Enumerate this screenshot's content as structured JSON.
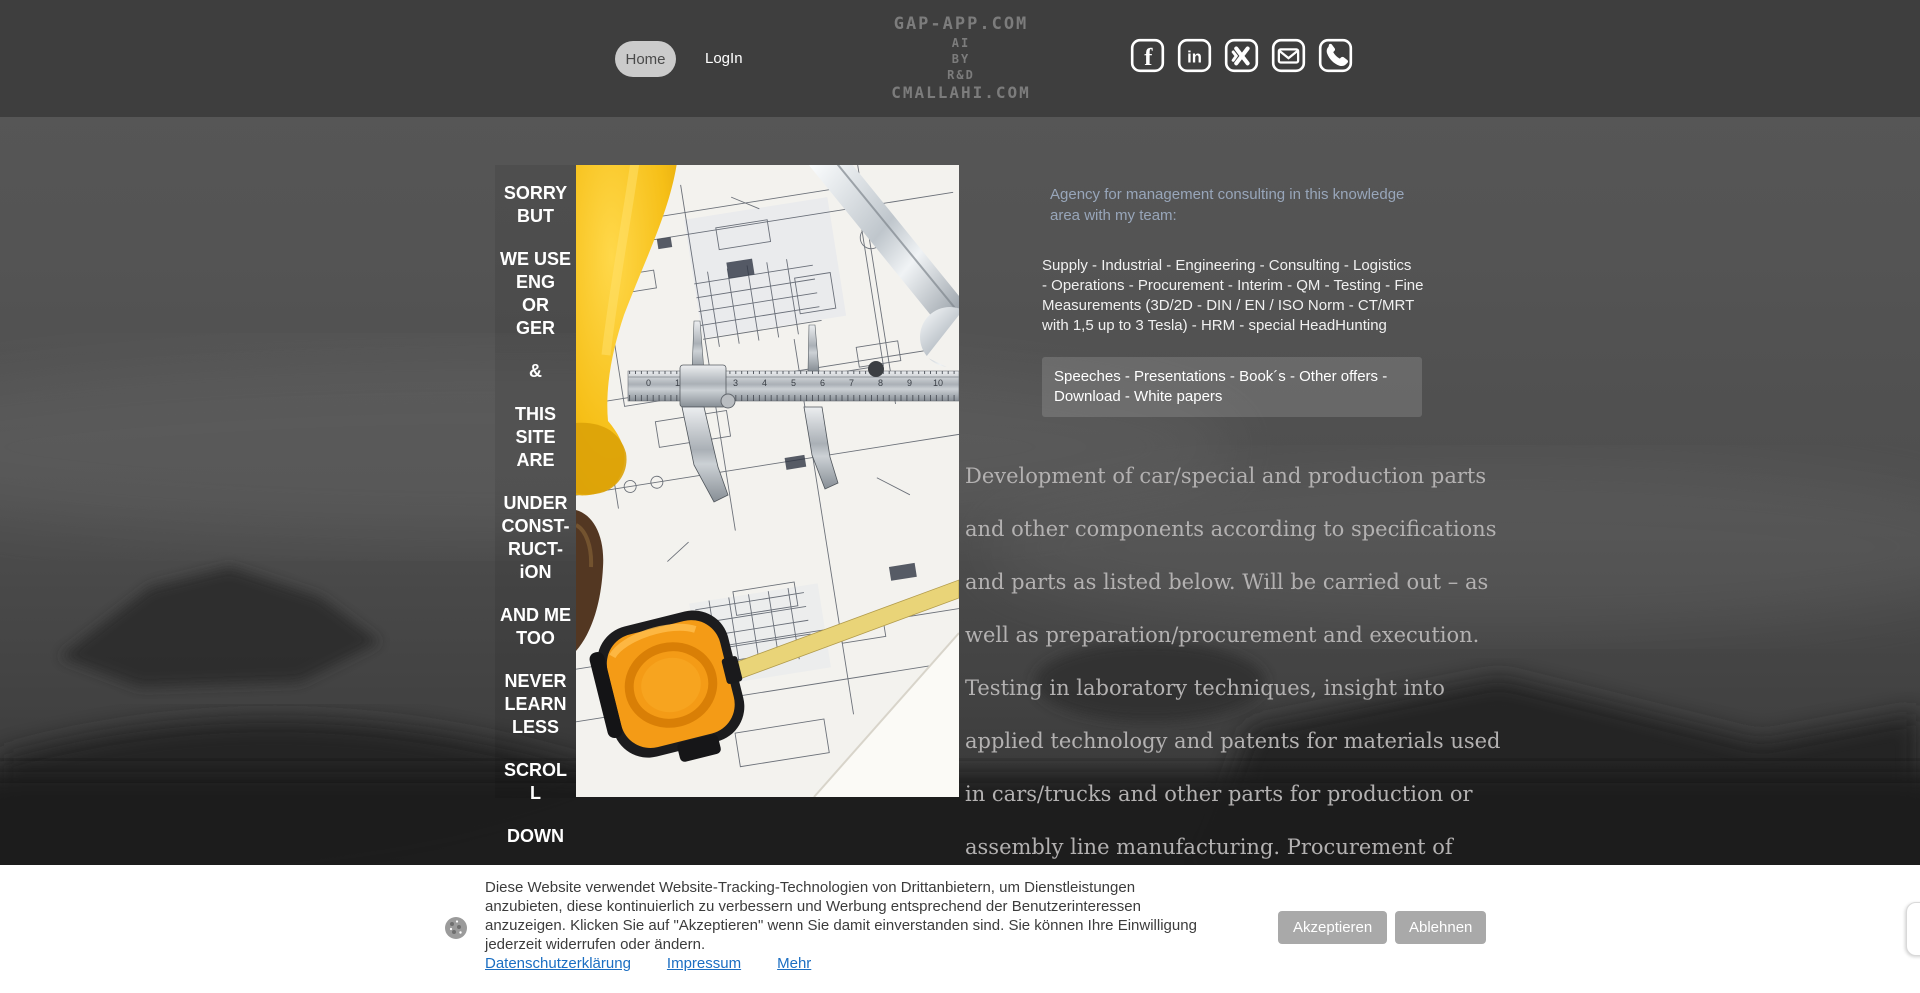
{
  "header": {
    "nav": {
      "home": "Home",
      "login": "LogIn"
    },
    "logo_lines": [
      "GAP-APP.COM",
      "AI",
      "BY",
      "R&D",
      "CMALLAHI.COM"
    ],
    "social_icons": [
      "facebook",
      "linkedin",
      "xing",
      "email",
      "phone"
    ]
  },
  "sidebar": {
    "paragraphs": [
      [
        "SORRY",
        "BUT"
      ],
      [
        "WE USE",
        "ENG",
        "OR",
        "GER"
      ],
      [
        "&"
      ],
      [
        "THIS",
        "SITE",
        "ARE"
      ],
      [
        "UNDER",
        "CONST-",
        "RUCT-",
        "iON"
      ],
      [
        "AND ME",
        "TOO"
      ],
      [
        "NEVER",
        "LEARN",
        "LESS"
      ],
      [
        "SCROL",
        "L"
      ],
      [
        "DOWN"
      ]
    ]
  },
  "content": {
    "agency_intro_lines": [
      "Agency for management consulting in this knowledge",
      "area with my team:"
    ],
    "services_lines": [
      " Supply - Industrial - Engineering -  Consulting - Logistics",
      "- Operations - Procurement - Interim - QM - Testing - Fine",
      "Measurements (3D/2D - DIN / EN / ISO Norm - CT/MRT",
      "with 1,5 up to 3 Tesla) - HRM - special HeadHunting"
    ],
    "offers_lines": [
      "Speeches - Presentations - Book´s - Other offers -",
      "Download - White papers"
    ],
    "description_lines": [
      "Development of car/special and production parts",
      "and other components according to specifications",
      "and parts as listed below. Will be carried out – as",
      "well as preparation/procurement and execution.",
      "Testing in laboratory techniques, insight into",
      "applied technology and patents for materials used",
      "in cars/trucks and other parts for production or",
      "assembly line manufacturing. Procurement of"
    ]
  },
  "cookie_banner": {
    "message_lines": [
      "Diese Website verwendet Website-Tracking-Technologien von Drittanbietern, um Dienstleistungen",
      "anzubieten, diese kontinuierlich zu verbessern und Werbung entsprechend der Benutzerinteressen",
      "anzuzeigen. Klicken Sie auf \"Akzeptieren\" wenn Sie damit einverstanden sind. Sie können Ihre Einwilligung",
      "jederzeit widerrufen oder ändern."
    ],
    "links": [
      "Datenschutzerklärung",
      "Impressum",
      "Mehr"
    ],
    "accept_label": "Akzeptieren",
    "decline_label": "Ablehnen"
  },
  "colors": {
    "header_bg": "#3e3e3e",
    "page_top": "#575757",
    "page_bottom": "#262626",
    "accent_blue_text": "#98a6ba",
    "link_blue": "#1b6ec2",
    "button_gray": "#a9a9a9",
    "hat_yellow": "#f6bf17",
    "tape_orange": "#f49b16"
  }
}
